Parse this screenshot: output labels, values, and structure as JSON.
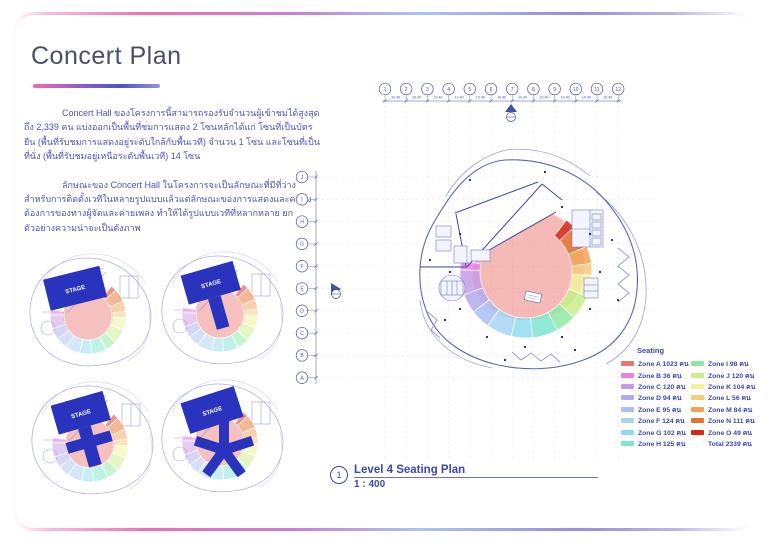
{
  "page": {
    "title": "Concert Plan"
  },
  "intro": {
    "paragraph1": "Concert Hall ของโครงการนี้สามารถรองรับจำนวนผู้เข้าชมได้สูงสุดถึง 2,339 คน แบ่งออกเป็นพื้นที่ชมการแสดง 2 โซนหลักได้แก่ โซนที่เป็นบัตรยืน (พื้นที่รับชมการแสดงอยู่ระดับใกล้กับพื้นเวที) จำนวน 1 โซน และโซนที่เป็นที่นั่ง (พื้นที่รับชมอยู่เหนือระดับพื้นเวที) 14 โซน",
    "paragraph2": "ลักษณะของ Concert Hall ในโครงการจะเป็นลักษณะที่มีที่ว่างสำหรับการติดตั้งเวทีในหลายรูปแบบแล้วแต่ลักษณะของการแสดงและความต้องการของทางผู้จัดและค่ายเพลง ทำให้ได้รูปแบบเวทีที่หลากหลาย ยกตัวอย่างความน่าจะเป็นดังภาพ"
  },
  "stage_color": "#2a33bd",
  "line_color": "#4450a8",
  "stage_diagrams": [
    {
      "stage_label": "STAGE",
      "shape": "rectangle"
    },
    {
      "stage_label": "STAGE",
      "shape": "t-runway"
    },
    {
      "stage_label": "STAGE",
      "shape": "cross-runway"
    },
    {
      "stage_label": "STAGE",
      "shape": "star-runway"
    }
  ],
  "plan": {
    "grid_columns": [
      "1",
      "2",
      "3",
      "4",
      "5",
      "6",
      "7",
      "8",
      "9",
      "10",
      "11",
      "12"
    ],
    "grid_dims": [
      "10.40",
      "20.00",
      "10.40",
      "10.40",
      "10.40",
      "10.40",
      "10.40",
      "10.40",
      "10.40",
      "10.40",
      "10.40"
    ],
    "grid_rows": [
      "J",
      "I",
      "H",
      "G",
      "F",
      "E",
      "D",
      "C",
      "B",
      "A"
    ]
  },
  "legend": {
    "title": "Seating",
    "left": [
      {
        "label": "Zone A 1023 คน",
        "color": "#ec746e"
      },
      {
        "label": "Zone B 36 คน",
        "color": "#e981e6"
      },
      {
        "label": "Zone C 120 คน",
        "color": "#c69ae9"
      },
      {
        "label": "Zone D 94 คน",
        "color": "#afabef"
      },
      {
        "label": "Zone E 95 คน",
        "color": "#a9c0f2"
      },
      {
        "label": "Zone F 124 คน",
        "color": "#a8d4f4"
      },
      {
        "label": "Zone G 102 คน",
        "color": "#90dcf0"
      },
      {
        "label": "Zone H 125 คน",
        "color": "#7de5cd"
      }
    ],
    "right": [
      {
        "label": "Zone I 98 คน",
        "color": "#8fe8a2"
      },
      {
        "label": "Zone J 120 คน",
        "color": "#c8ee8a"
      },
      {
        "label": "Zone K 104 คน",
        "color": "#f2f19c"
      },
      {
        "label": "Zone L 56 คน",
        "color": "#f7ca7c"
      },
      {
        "label": "Zone M 84 คน",
        "color": "#f2a254"
      },
      {
        "label": "Zone N 111 คน",
        "color": "#e37430"
      },
      {
        "label": "Zone O 49 คน",
        "color": "#d8281a"
      },
      {
        "label": "Total 2339 คน",
        "color": ""
      }
    ]
  },
  "caption": {
    "number": "1",
    "title": "Level 4 Seating Plan",
    "scale": "1 : 400"
  }
}
